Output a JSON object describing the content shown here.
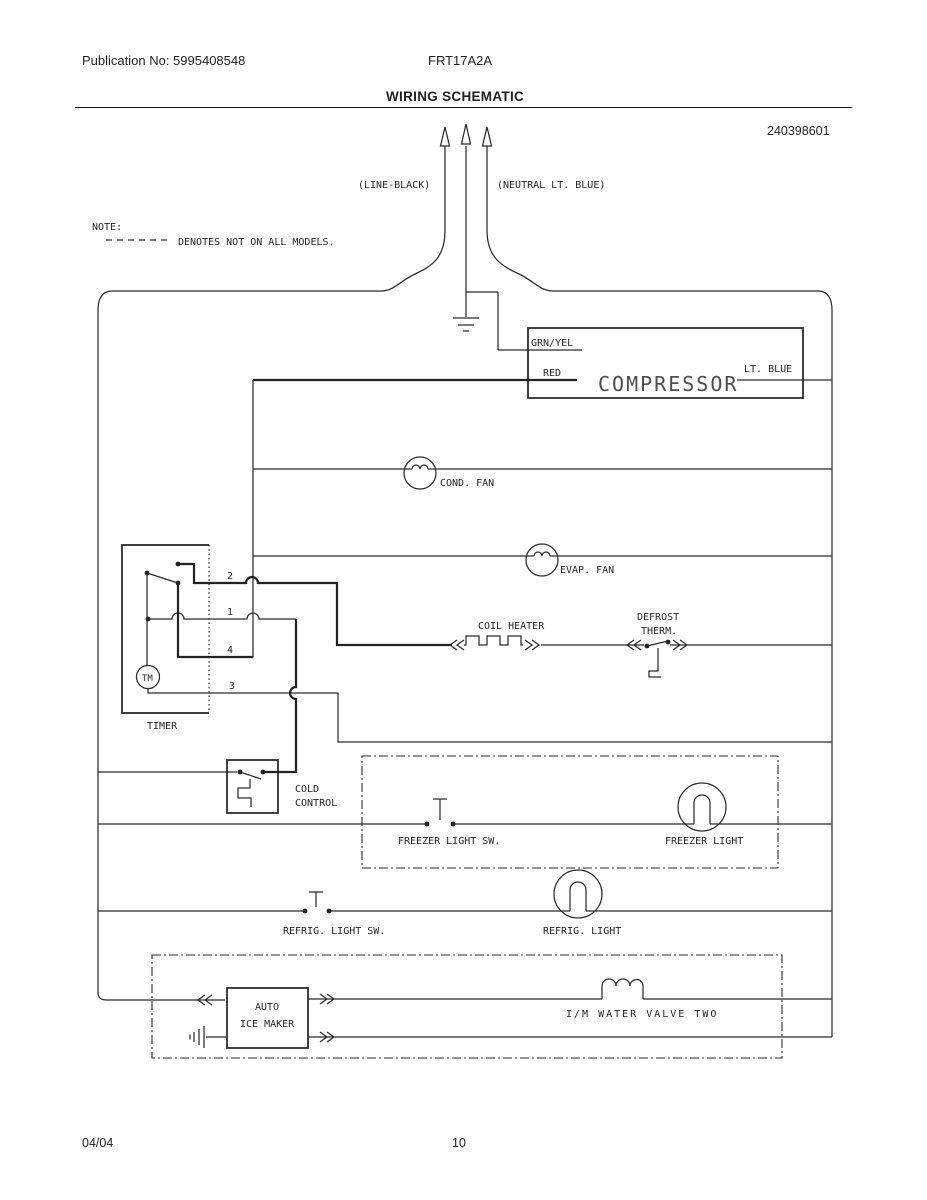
{
  "header": {
    "publication": "Publication No: 5995408548",
    "model": "FRT17A2A",
    "title": "WIRING SCHEMATIC"
  },
  "footer": {
    "date": "04/04",
    "page": "10"
  },
  "diagram": {
    "part_number": "240398601",
    "note_label": "NOTE:",
    "note_text": "DENOTES NOT ON ALL MODELS.",
    "plug": {
      "line": "(LINE-BLACK)",
      "neutral": "(NEUTRAL LT. BLUE)"
    },
    "compressor": {
      "grn_yel": "GRN/YEL",
      "red": "RED",
      "name": "COMPRESSOR",
      "lt_blue": "LT. BLUE"
    },
    "cond_fan": "COND. FAN",
    "evap_fan": "EVAP. FAN",
    "coil_heater": "COIL HEATER",
    "defrost_line1": "DEFROST",
    "defrost_line2": "THERM.",
    "timer": {
      "label": "TIMER",
      "motor": "TM",
      "t1": "1",
      "t2": "2",
      "t3": "3",
      "t4": "4"
    },
    "cold_control_line1": "COLD",
    "cold_control_line2": "CONTROL",
    "freezer_light_switch": "FREEZER LIGHT SW.",
    "freezer_light": "FREEZER LIGHT",
    "refrig_light_switch": "REFRIG. LIGHT SW.",
    "refrig_light": "REFRIG. LIGHT",
    "ice_maker_line1": "AUTO",
    "ice_maker_line2": "ICE MAKER",
    "water_valve": "I/M WATER VALVE TWO"
  },
  "colors": {
    "ink": "#222222",
    "paper": "#ffffff",
    "compressor_text": "#4d4d4d"
  }
}
